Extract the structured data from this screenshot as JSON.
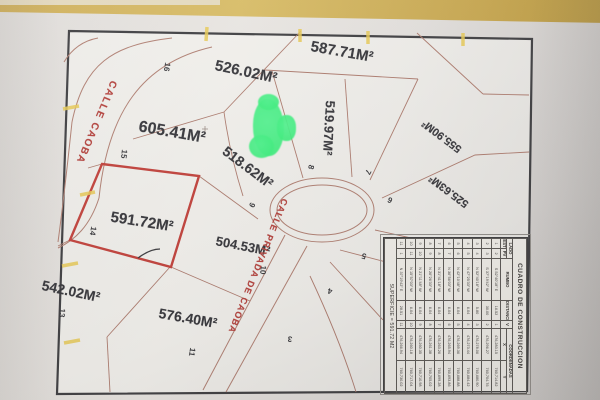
{
  "colors": {
    "highlight_green": "#45f287",
    "highlight_yellow": "#e8ca55",
    "street_red": "#b5413c",
    "parcel_line_brown": "#ad7b6e",
    "bold_parcel_red": "#c2403a",
    "map_border_dark": "#3d3d40",
    "paper": "#e6e3e0",
    "desk_tan": "#cdad58"
  },
  "map": {
    "street_labels": [
      {
        "text": "CALLE CAOBA"
      },
      {
        "text": "CALLE PRIVADA DE CAOBA"
      }
    ],
    "area_labels": [
      {
        "text": "587.71M²"
      },
      {
        "text": "526.02M²"
      },
      {
        "text": "605.41M²"
      },
      {
        "text": "518.62M²"
      },
      {
        "text": "519.97M²"
      },
      {
        "text": "555.90M²"
      },
      {
        "text": "525.63M²"
      },
      {
        "text": "591.72M²"
      },
      {
        "text": "504.53M²"
      },
      {
        "text": "542.02M²"
      },
      {
        "text": "576.40M²"
      }
    ],
    "lot_numbers": [
      {
        "text": "16"
      },
      {
        "text": "15"
      },
      {
        "text": "14"
      },
      {
        "text": "13"
      },
      {
        "text": "11"
      },
      {
        "text": "10"
      },
      {
        "text": "9"
      },
      {
        "text": "8"
      },
      {
        "text": "7"
      },
      {
        "text": "6"
      },
      {
        "text": "5"
      },
      {
        "text": "4"
      },
      {
        "text": "3"
      }
    ]
  },
  "table": {
    "title": "CUADRO DE CONSTRUCCION",
    "col_lado": "LADO",
    "col_est": "EST",
    "col_pv": "PV",
    "col_rumbo": "RUMBO",
    "col_distancia": "DISTANCIA",
    "col_v": "V",
    "col_coordenadas": "COORDENADAS",
    "col_x": "X",
    "col_y": "Y",
    "rows": [
      {
        "est": "1",
        "pv": "2",
        "rumbo": "S 52°40'18\" E",
        "dist": "16.52",
        "v": "1",
        "x": "476,283.15",
        "y": "760,714.82"
      },
      {
        "est": "2",
        "pv": "3",
        "rumbo": "S 37°19'42\" W",
        "dist": "30.00",
        "v": "2",
        "x": "476,296.27",
        "y": "760,704.76"
      },
      {
        "est": "3",
        "pv": "4",
        "rumbo": "N 52°40'18\" W",
        "dist": "5.80",
        "v": "3",
        "x": "476,278.06",
        "y": "760,680.90"
      },
      {
        "est": "4",
        "pv": "5",
        "rumbo": "N 47°25'33\" W",
        "dist": "6.04",
        "v": "4",
        "x": "476,273.44",
        "y": "760,684.42"
      },
      {
        "est": "5",
        "pv": "6",
        "rumbo": "N 42°10'48\" W",
        "dist": "6.04",
        "v": "5",
        "x": "476,269.36",
        "y": "760,688.88"
      },
      {
        "est": "6",
        "pv": "7",
        "rumbo": "N 36°56'03\" W",
        "dist": "6.04",
        "v": "6",
        "x": "476,265.94",
        "y": "760,693.86"
      },
      {
        "est": "7",
        "pv": "8",
        "rumbo": "N 31°41'18\" W",
        "dist": "6.04",
        "v": "7",
        "x": "476,263.26",
        "y": "760,699.28"
      },
      {
        "est": "8",
        "pv": "9",
        "rumbo": "N 26°26'33\" W",
        "dist": "6.04",
        "v": "8",
        "x": "476,261.38",
        "y": "760,705.02"
      },
      {
        "est": "9",
        "pv": "10",
        "rumbo": "N 21°11'48\" W",
        "dist": "6.04",
        "v": "9",
        "x": "476,260.35",
        "y": "760,710.98"
      },
      {
        "est": "10",
        "pv": "11",
        "rumbo": "N 15°57'03\" W",
        "dist": "6.04",
        "v": "10",
        "x": "476,260.18",
        "y": "760,717.04"
      },
      {
        "est": "11",
        "pv": "1",
        "rumbo": "N 37°19'42\" E",
        "dist": "28.51",
        "v": "11",
        "x": "476,266.94",
        "y": "760,730.02"
      }
    ],
    "footer": "SUPERFICIE = 591.72 M2"
  }
}
